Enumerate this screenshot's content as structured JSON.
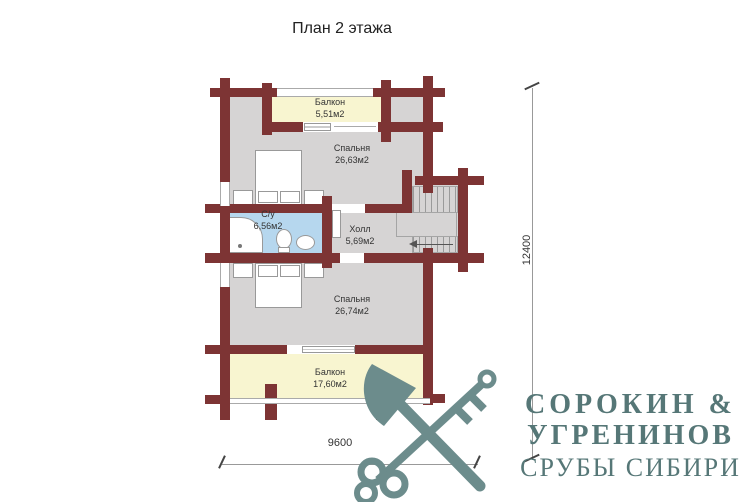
{
  "title": "План 2 этажа",
  "floor_plan": {
    "rooms": [
      {
        "name": "Балкон",
        "area": "5,51м2"
      },
      {
        "name": "Спальня",
        "area": "26,63м2"
      },
      {
        "name": "С/у",
        "area": "6,56м2"
      },
      {
        "name": "Холл",
        "area": "5,69м2"
      },
      {
        "name": "Спальня",
        "area": "26,74м2"
      },
      {
        "name": "Балкон",
        "area": "17,60м2"
      }
    ],
    "dimensions": {
      "vertical": "12400",
      "horizontal": "9600"
    }
  },
  "logo": {
    "line1": "СОРОКИН &",
    "line2": "УГРЕНИНОВ",
    "line3": "СРУБЫ СИБИРИ",
    "icon": "crossed-axe-and-key"
  },
  "colors": {
    "wall": "#7d3434",
    "floor": "#d6d4d4",
    "balcony": "#f8f5d0",
    "bathroom": "#b6d7ee",
    "logo_icon": "#6c8c8c",
    "logo_text": "#567777"
  }
}
